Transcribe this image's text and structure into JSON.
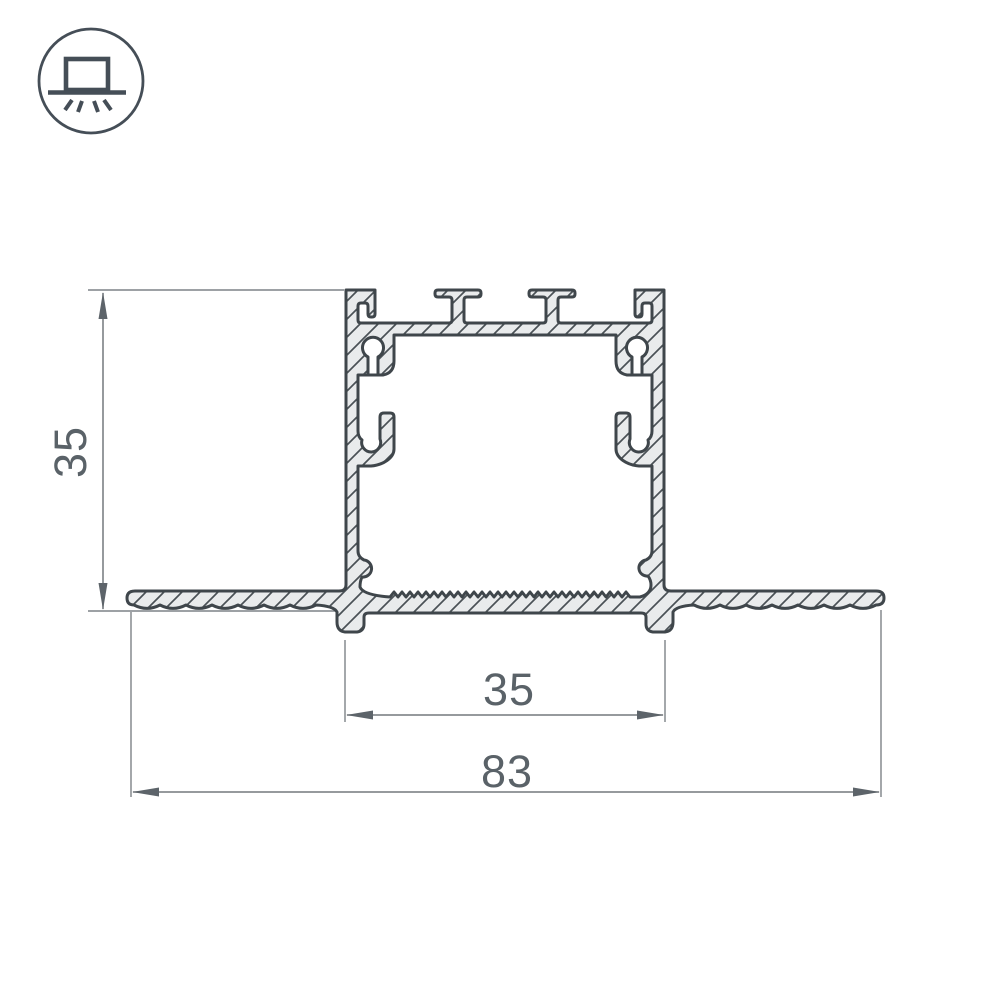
{
  "drawing_title": "recessed-aluminium-profile-cross-section",
  "dimensions": {
    "height": "35",
    "recess_width": "35",
    "overall_width": "83"
  },
  "icon": {
    "name": "recessed-mount-light-icon",
    "meaning": "recessed / flush ceiling mounting"
  },
  "colors": {
    "outline": "#3f464b",
    "metal_fill": "#e9ebec",
    "hatch": "#4a5156",
    "dim_line": "#74797d",
    "dim_text": "#5a6268",
    "icon_stroke": "#454e57",
    "background": "#ffffff"
  }
}
